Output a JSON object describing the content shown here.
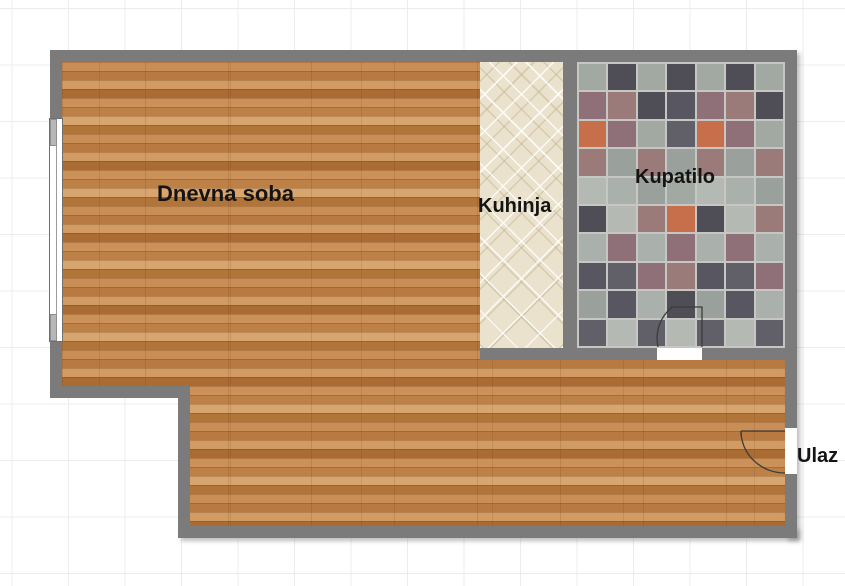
{
  "floorplan": {
    "rooms": [
      {
        "id": "living-room",
        "label": "Dnevna soba"
      },
      {
        "id": "kitchen",
        "label": "Kuhinja"
      },
      {
        "id": "bathroom",
        "label": "Kupatilo"
      },
      {
        "id": "entrance",
        "label": "Ulaz"
      }
    ],
    "colors": {
      "wall": "#7b7b7b",
      "grid_line": "#ececec",
      "background": "#ffffff",
      "wood_base": "#c08348",
      "kitchen_tile": "#ebe2cd",
      "grout": "#c6c6c2",
      "label": "#141414",
      "door_line": "#3c3c3c"
    },
    "bathroom_tile_palette": [
      "#a2a9a3",
      "#585660",
      "#b4bab3",
      "#8f7079",
      "#9aa19c",
      "#4f4d55",
      "#c76f4b",
      "#615f67",
      "#aab0ab",
      "#9b7a7a"
    ]
  }
}
